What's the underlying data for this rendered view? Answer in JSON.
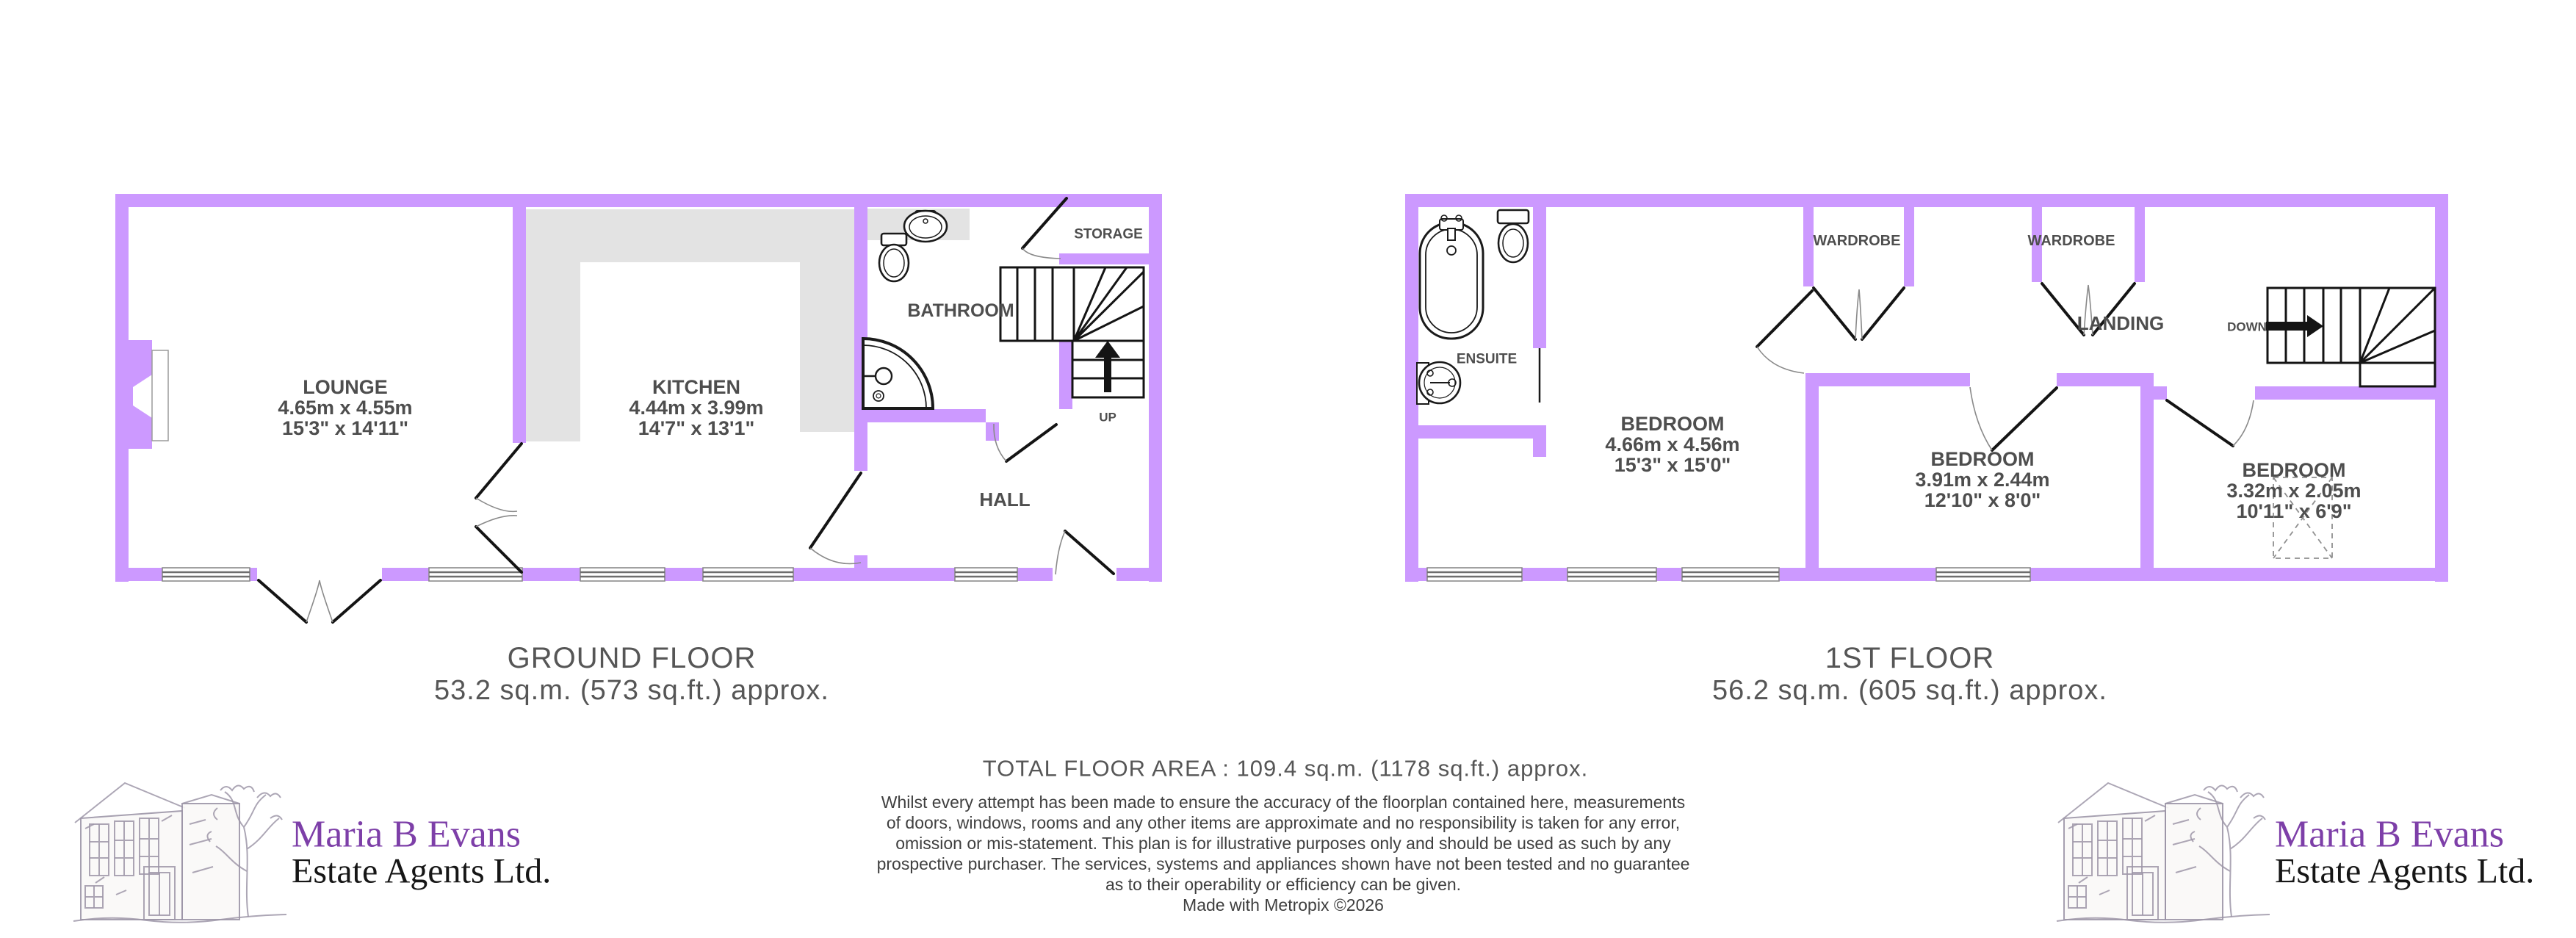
{
  "colors": {
    "wall": "#CC99FF",
    "counter": "#E3E3E3",
    "room_label": "#4E4E4E",
    "title_text": "#565656",
    "body_text": "#3F3F3F",
    "logo_purple": "#7D3FA8",
    "logo_black": "#161616",
    "fixture_line": "#1A1A1A"
  },
  "ground_floor": {
    "title": "GROUND FLOOR",
    "area": "53.2 sq.m. (573 sq.ft.) approx.",
    "stairs_label": "UP",
    "rooms": {
      "lounge": {
        "name": "LOUNGE",
        "metric": "4.65m x 4.55m",
        "imperial": "15'3\" x 14'11\""
      },
      "kitchen": {
        "name": "KITCHEN",
        "metric": "4.44m x 3.99m",
        "imperial": "14'7\" x 13'1\""
      },
      "bathroom": {
        "name": "BATHROOM"
      },
      "hall": {
        "name": "HALL"
      },
      "storage": {
        "name": "STORAGE"
      }
    }
  },
  "first_floor": {
    "title": "1ST FLOOR",
    "area": "56.2 sq.m. (605 sq.ft.) approx.",
    "stairs_label": "DOWN",
    "rooms": {
      "bedroom1": {
        "name": "BEDROOM",
        "metric": "4.66m x 4.56m",
        "imperial": "15'3\" x 15'0\""
      },
      "bedroom2": {
        "name": "BEDROOM",
        "metric": "3.91m x 2.44m",
        "imperial": "12'10\" x 8'0\""
      },
      "bedroom3": {
        "name": "BEDROOM",
        "metric": "3.32m x 2.05m",
        "imperial": "10'11\" x 6'9\""
      },
      "ensuite": {
        "name": "ENSUITE"
      },
      "landing": {
        "name": "LANDING"
      },
      "wardrobe1": {
        "name": "WARDROBE"
      },
      "wardrobe2": {
        "name": "WARDROBE"
      }
    }
  },
  "summary": {
    "total": "TOTAL FLOOR AREA : 109.4 sq.m. (1178 sq.ft.) approx.",
    "disclaimer_lines": [
      "Whilst every attempt has been made to ensure the accuracy of the floorplan contained here, measurements",
      "of doors, windows, rooms and any other items are approximate and no responsibility is taken for any error,",
      "omission or mis-statement. This plan is for illustrative purposes only and should be used as such by any",
      "prospective purchaser. The services, systems and appliances shown have not been tested and no guarantee",
      "as to their operability or efficiency can be given."
    ],
    "credit": "Made with Metropix ©2026"
  },
  "logo": {
    "line1": "Maria B Evans",
    "line2": "Estate Agents Ltd."
  }
}
